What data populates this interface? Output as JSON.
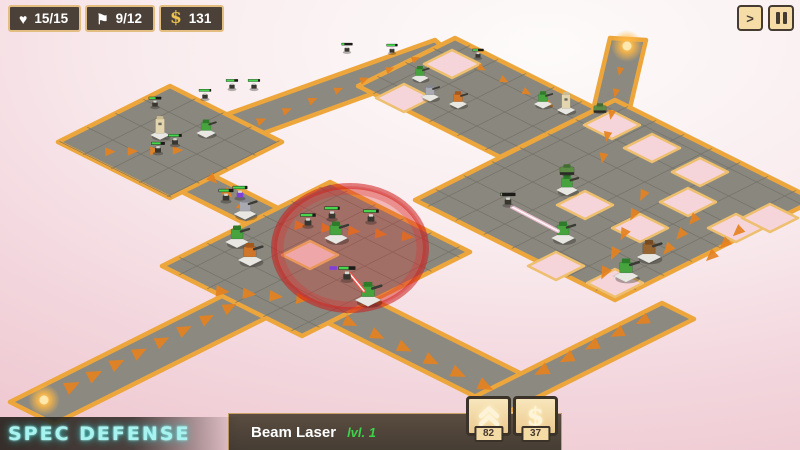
{
  "hud": {
    "lives": {
      "icon": "heart-icon",
      "glyph": "♥",
      "value": "15/15"
    },
    "waves": {
      "icon": "flag-icon",
      "glyph": "⚑",
      "value": "9/12"
    },
    "money": {
      "icon": "dollar-icon",
      "glyph": "$",
      "value": "131"
    },
    "speed_label": ">"
  },
  "branding": {
    "logo": "Spec Defense"
  },
  "selection": {
    "name": "Beam Laser",
    "level_label": "lvl. 1",
    "upgrade_cost": "82",
    "sell_value": "37",
    "sell_icon_glyph": "$"
  },
  "colors": {
    "accent_gold": "#eda63c",
    "panel_dark": "#4b4138",
    "panel_border_tan": "#e4be80",
    "button_tan": "#f4daa4",
    "button_border": "#3b332a",
    "logo_cyan": "#a8f3f0",
    "level_green": "#3ed24b",
    "platform": "#8a887e",
    "road": "#8b8980",
    "groove": "#6e6c63",
    "hole": "#f5d4da",
    "hole_border": "#edbf6e",
    "arrow": "#e5811f",
    "hp": "#46d74c",
    "hp_bg": "#1d1b18",
    "shield": "#8040d8",
    "range_red": "#d92f2a",
    "beam_red": "#ff4e42",
    "beam_pink": "#ffc9de",
    "spawn": "#ffb845",
    "tower_palette": {
      "green": [
        "#46a33e",
        "#2e7c2a"
      ],
      "orange": [
        "#d0762a",
        "#a5571c"
      ],
      "gray": [
        "#a9a9b1",
        "#86868f"
      ],
      "brown": [
        "#98642f",
        "#744b22"
      ],
      "tan": [
        "#e3d5ad",
        "#cbbc92"
      ]
    }
  },
  "scene": {
    "roads": [
      {
        "name": "road-southwest-spawn",
        "pts": [
          [
            10,
            402
          ],
          [
            252,
            281
          ],
          [
            296,
            303
          ],
          [
            54,
            424
          ]
        ]
      },
      {
        "name": "road-northwest-connector",
        "pts": [
          [
            162,
            182
          ],
          [
            194,
            166
          ],
          [
            280,
            209
          ],
          [
            248,
            225
          ]
        ]
      },
      {
        "name": "road-northwest-to-north",
        "pts": [
          [
            225,
            115
          ],
          [
            435,
            40
          ],
          [
            460,
            62
          ],
          [
            250,
            138
          ]
        ]
      },
      {
        "name": "road-north-spawn",
        "pts": [
          [
            577,
            178
          ],
          [
            610,
            38
          ],
          [
            646,
            40
          ],
          [
            613,
            180
          ]
        ]
      },
      {
        "name": "road-central-south",
        "pts": [
          [
            302,
            310
          ],
          [
            348,
            287
          ],
          [
            522,
            374
          ],
          [
            476,
            397
          ]
        ]
      },
      {
        "name": "road-bottom-east",
        "pts": [
          [
            472,
            398
          ],
          [
            662,
            303
          ],
          [
            694,
            319
          ],
          [
            504,
            414
          ]
        ]
      }
    ],
    "platforms": [
      {
        "name": "platform-northwest",
        "pts": [
          [
            170,
            86
          ],
          [
            58,
            142
          ],
          [
            170,
            198
          ],
          [
            282,
            142
          ]
        ]
      },
      {
        "name": "platform-central",
        "pts": [
          [
            330,
            182
          ],
          [
            162,
            266
          ],
          [
            302,
            336
          ],
          [
            470,
            252
          ]
        ]
      },
      {
        "name": "platform-north",
        "pts": [
          [
            455,
            38
          ],
          [
            358,
            86
          ],
          [
            500,
            157
          ],
          [
            597,
            109
          ]
        ]
      },
      {
        "name": "platform-east",
        "pts": [
          [
            615,
            100
          ],
          [
            415,
            200
          ],
          [
            615,
            300
          ],
          [
            815,
            200
          ]
        ]
      }
    ],
    "holes": [
      [
        310,
        255
      ],
      [
        452,
        64
      ],
      [
        404,
        98
      ],
      [
        585,
        205
      ],
      [
        688,
        202
      ],
      [
        640,
        228
      ],
      [
        736,
        228
      ],
      [
        615,
        283
      ],
      [
        556,
        266
      ],
      [
        652,
        148
      ],
      [
        700,
        172
      ],
      [
        612,
        125
      ],
      [
        770,
        218
      ]
    ],
    "arrow_chains": [
      {
        "a": [
          60,
          392
        ],
        "b": [
          240,
          302
        ],
        "n": 8
      },
      {
        "a": [
          98,
          152
        ],
        "b": [
          188,
          150
        ],
        "n": 4
      },
      {
        "a": [
          205,
          172
        ],
        "b": [
          250,
          214
        ],
        "n": 3
      },
      {
        "a": [
          248,
          126
        ],
        "b": [
          428,
          54
        ],
        "n": 7
      },
      {
        "a": [
          470,
          62
        ],
        "b": [
          560,
          110
        ],
        "n": 4
      },
      {
        "a": [
          622,
          60
        ],
        "b": [
          601,
          168
        ],
        "n": 5
      },
      {
        "a": [
          286,
          224
        ],
        "b": [
          420,
          238
        ],
        "n": 5
      },
      {
        "a": [
          208,
          290
        ],
        "b": [
          315,
          300
        ],
        "n": 4
      },
      {
        "a": [
          336,
          316
        ],
        "b": [
          498,
          392
        ],
        "n": 6
      },
      {
        "a": [
          648,
          185
        ],
        "b": [
          600,
          282
        ],
        "n": 5
      },
      {
        "a": [
          700,
          212
        ],
        "b": [
          662,
          256
        ],
        "n": 3
      },
      {
        "a": [
          656,
          314
        ],
        "b": [
          530,
          377
        ],
        "n": 5
      },
      {
        "a": [
          745,
          225
        ],
        "b": [
          705,
          262
        ],
        "n": 3
      }
    ],
    "spawns": [
      [
        44,
        400
      ],
      [
        627,
        46
      ]
    ],
    "selection_range": {
      "cx": 350,
      "cy": 248,
      "rx": 76,
      "ry": 62
    },
    "towers": [
      {
        "x": 160,
        "y": 135,
        "type": "tan"
      },
      {
        "x": 206,
        "y": 133,
        "type": "green"
      },
      {
        "x": 245,
        "y": 214,
        "type": "gray"
      },
      {
        "x": 420,
        "y": 78,
        "type": "green"
      },
      {
        "x": 430,
        "y": 97,
        "type": "gray"
      },
      {
        "x": 458,
        "y": 104,
        "type": "orange"
      },
      {
        "x": 543,
        "y": 104,
        "type": "green"
      },
      {
        "x": 566,
        "y": 110,
        "type": "tan"
      },
      {
        "x": 336,
        "y": 238,
        "type": "green",
        "selected": true
      },
      {
        "x": 237,
        "y": 242,
        "type": "green"
      },
      {
        "x": 250,
        "y": 260,
        "type": "orange"
      },
      {
        "x": 368,
        "y": 300,
        "type": "green"
      },
      {
        "x": 563,
        "y": 238,
        "type": "green"
      },
      {
        "x": 567,
        "y": 190,
        "type": "green"
      },
      {
        "x": 626,
        "y": 276,
        "type": "green"
      },
      {
        "x": 649,
        "y": 257,
        "type": "brown"
      }
    ],
    "beams": [
      {
        "from": [
          364,
          291
        ],
        "to": [
          350,
          274
        ],
        "color": "red"
      },
      {
        "from": [
          558,
          231
        ],
        "to": [
          512,
          207
        ],
        "color": "pink"
      }
    ],
    "enemies": [
      {
        "x": 155,
        "y": 107,
        "hp": 0.55
      },
      {
        "x": 205,
        "y": 99,
        "hp": 0.9
      },
      {
        "x": 232,
        "y": 89,
        "hp": 0.7
      },
      {
        "x": 254,
        "y": 89,
        "hp": 0.85
      },
      {
        "x": 347,
        "y": 52,
        "hp": 0.25
      },
      {
        "x": 392,
        "y": 53,
        "hp": 0.8
      },
      {
        "x": 175,
        "y": 145,
        "hp": 0.8
      },
      {
        "x": 158,
        "y": 153,
        "hp": 0.7
      },
      {
        "x": 226,
        "y": 201,
        "hp": 0.7
      },
      {
        "x": 240,
        "y": 198,
        "hp": 0.85,
        "body": "purple"
      },
      {
        "x": 332,
        "y": 219,
        "hp": 0.9
      },
      {
        "x": 308,
        "y": 226,
        "hp": 0.8
      },
      {
        "x": 371,
        "y": 222,
        "hp": 0.85
      },
      {
        "x": 347,
        "y": 280,
        "hp": 0.6,
        "shield": true
      },
      {
        "x": 508,
        "y": 205,
        "hp": 0.08
      },
      {
        "x": 478,
        "y": 58,
        "hp": 0.5
      },
      {
        "x": 600,
        "y": 112,
        "tank": true
      },
      {
        "x": 567,
        "y": 174,
        "tank": true
      }
    ]
  }
}
